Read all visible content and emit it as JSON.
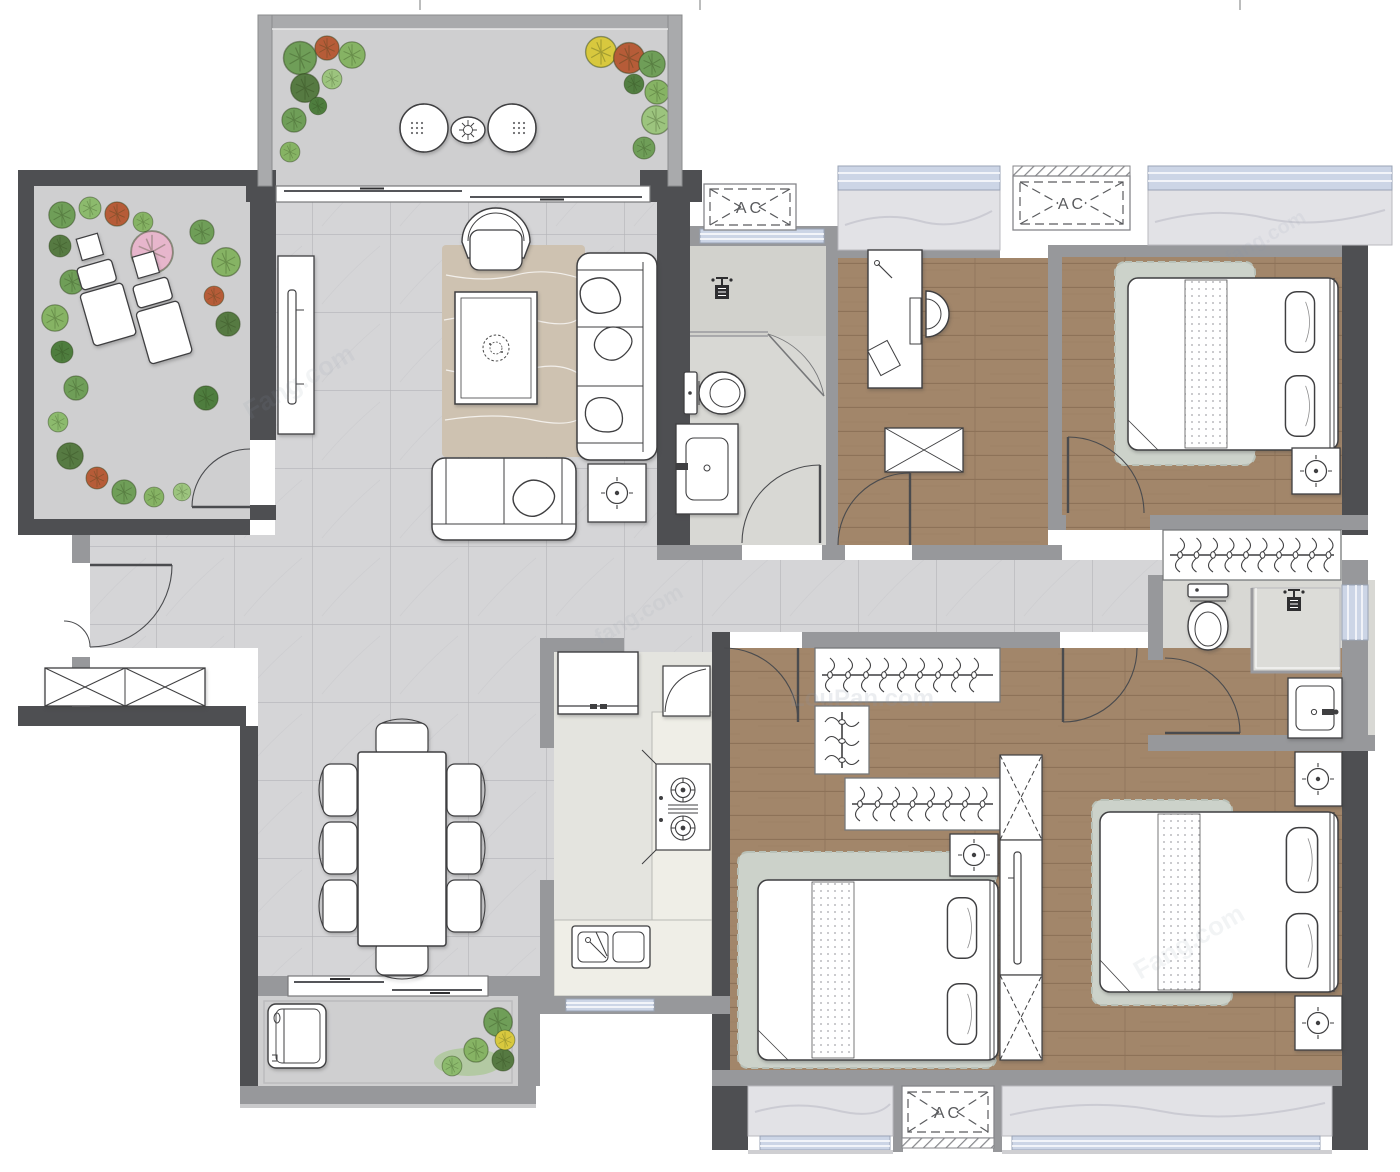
{
  "plan": {
    "type": "residential-floor-plan",
    "rooms": [
      "balcony-north",
      "terrace-west",
      "living-room",
      "dining-area",
      "kitchen",
      "laundry-balcony",
      "entry",
      "hallway",
      "bathroom-guest",
      "study",
      "bedroom-2",
      "bedroom-3",
      "bedroom-master",
      "bathroom-master"
    ]
  },
  "labels": {
    "ac": "AC"
  },
  "ac_units": [
    {
      "label": "AC"
    },
    {
      "label": "AC"
    },
    {
      "label": "AC"
    }
  ],
  "watermarks": [
    "Fang.com",
    "fang.com",
    "LouPan.com",
    "Fang.com",
    "fang.com"
  ],
  "palette": {
    "wall-dark": "#4e4f52",
    "wall-gray": "#97989b",
    "parapet": "#a9aaac",
    "tile": "#d5d5d7",
    "tile-line": "#b4b4b8",
    "wood": "#a2866a",
    "wood-line": "#8a6f55",
    "bath": "#d8d8d4",
    "kitchen": "#e4e4df",
    "counter": "#efeee7",
    "balcony": "#cfcfd0",
    "marble": "#e2e2e6",
    "marble-line": "#c6c6ce",
    "window": "#ccd5e6",
    "rug-living": "#cec2b1",
    "rug-bed": "#ccd2ca",
    "stroke": "#3f3f41",
    "door": "#4a4b4e",
    "green-1": "#6f9e58",
    "green-2": "#86b364",
    "green-3": "#567a42",
    "green-4": "#9cc47e",
    "accent-rust": "#b65c38",
    "accent-yellow": "#d8c83e",
    "accent-pink": "#e7b6cc",
    "watermark": "#8b97a8"
  }
}
